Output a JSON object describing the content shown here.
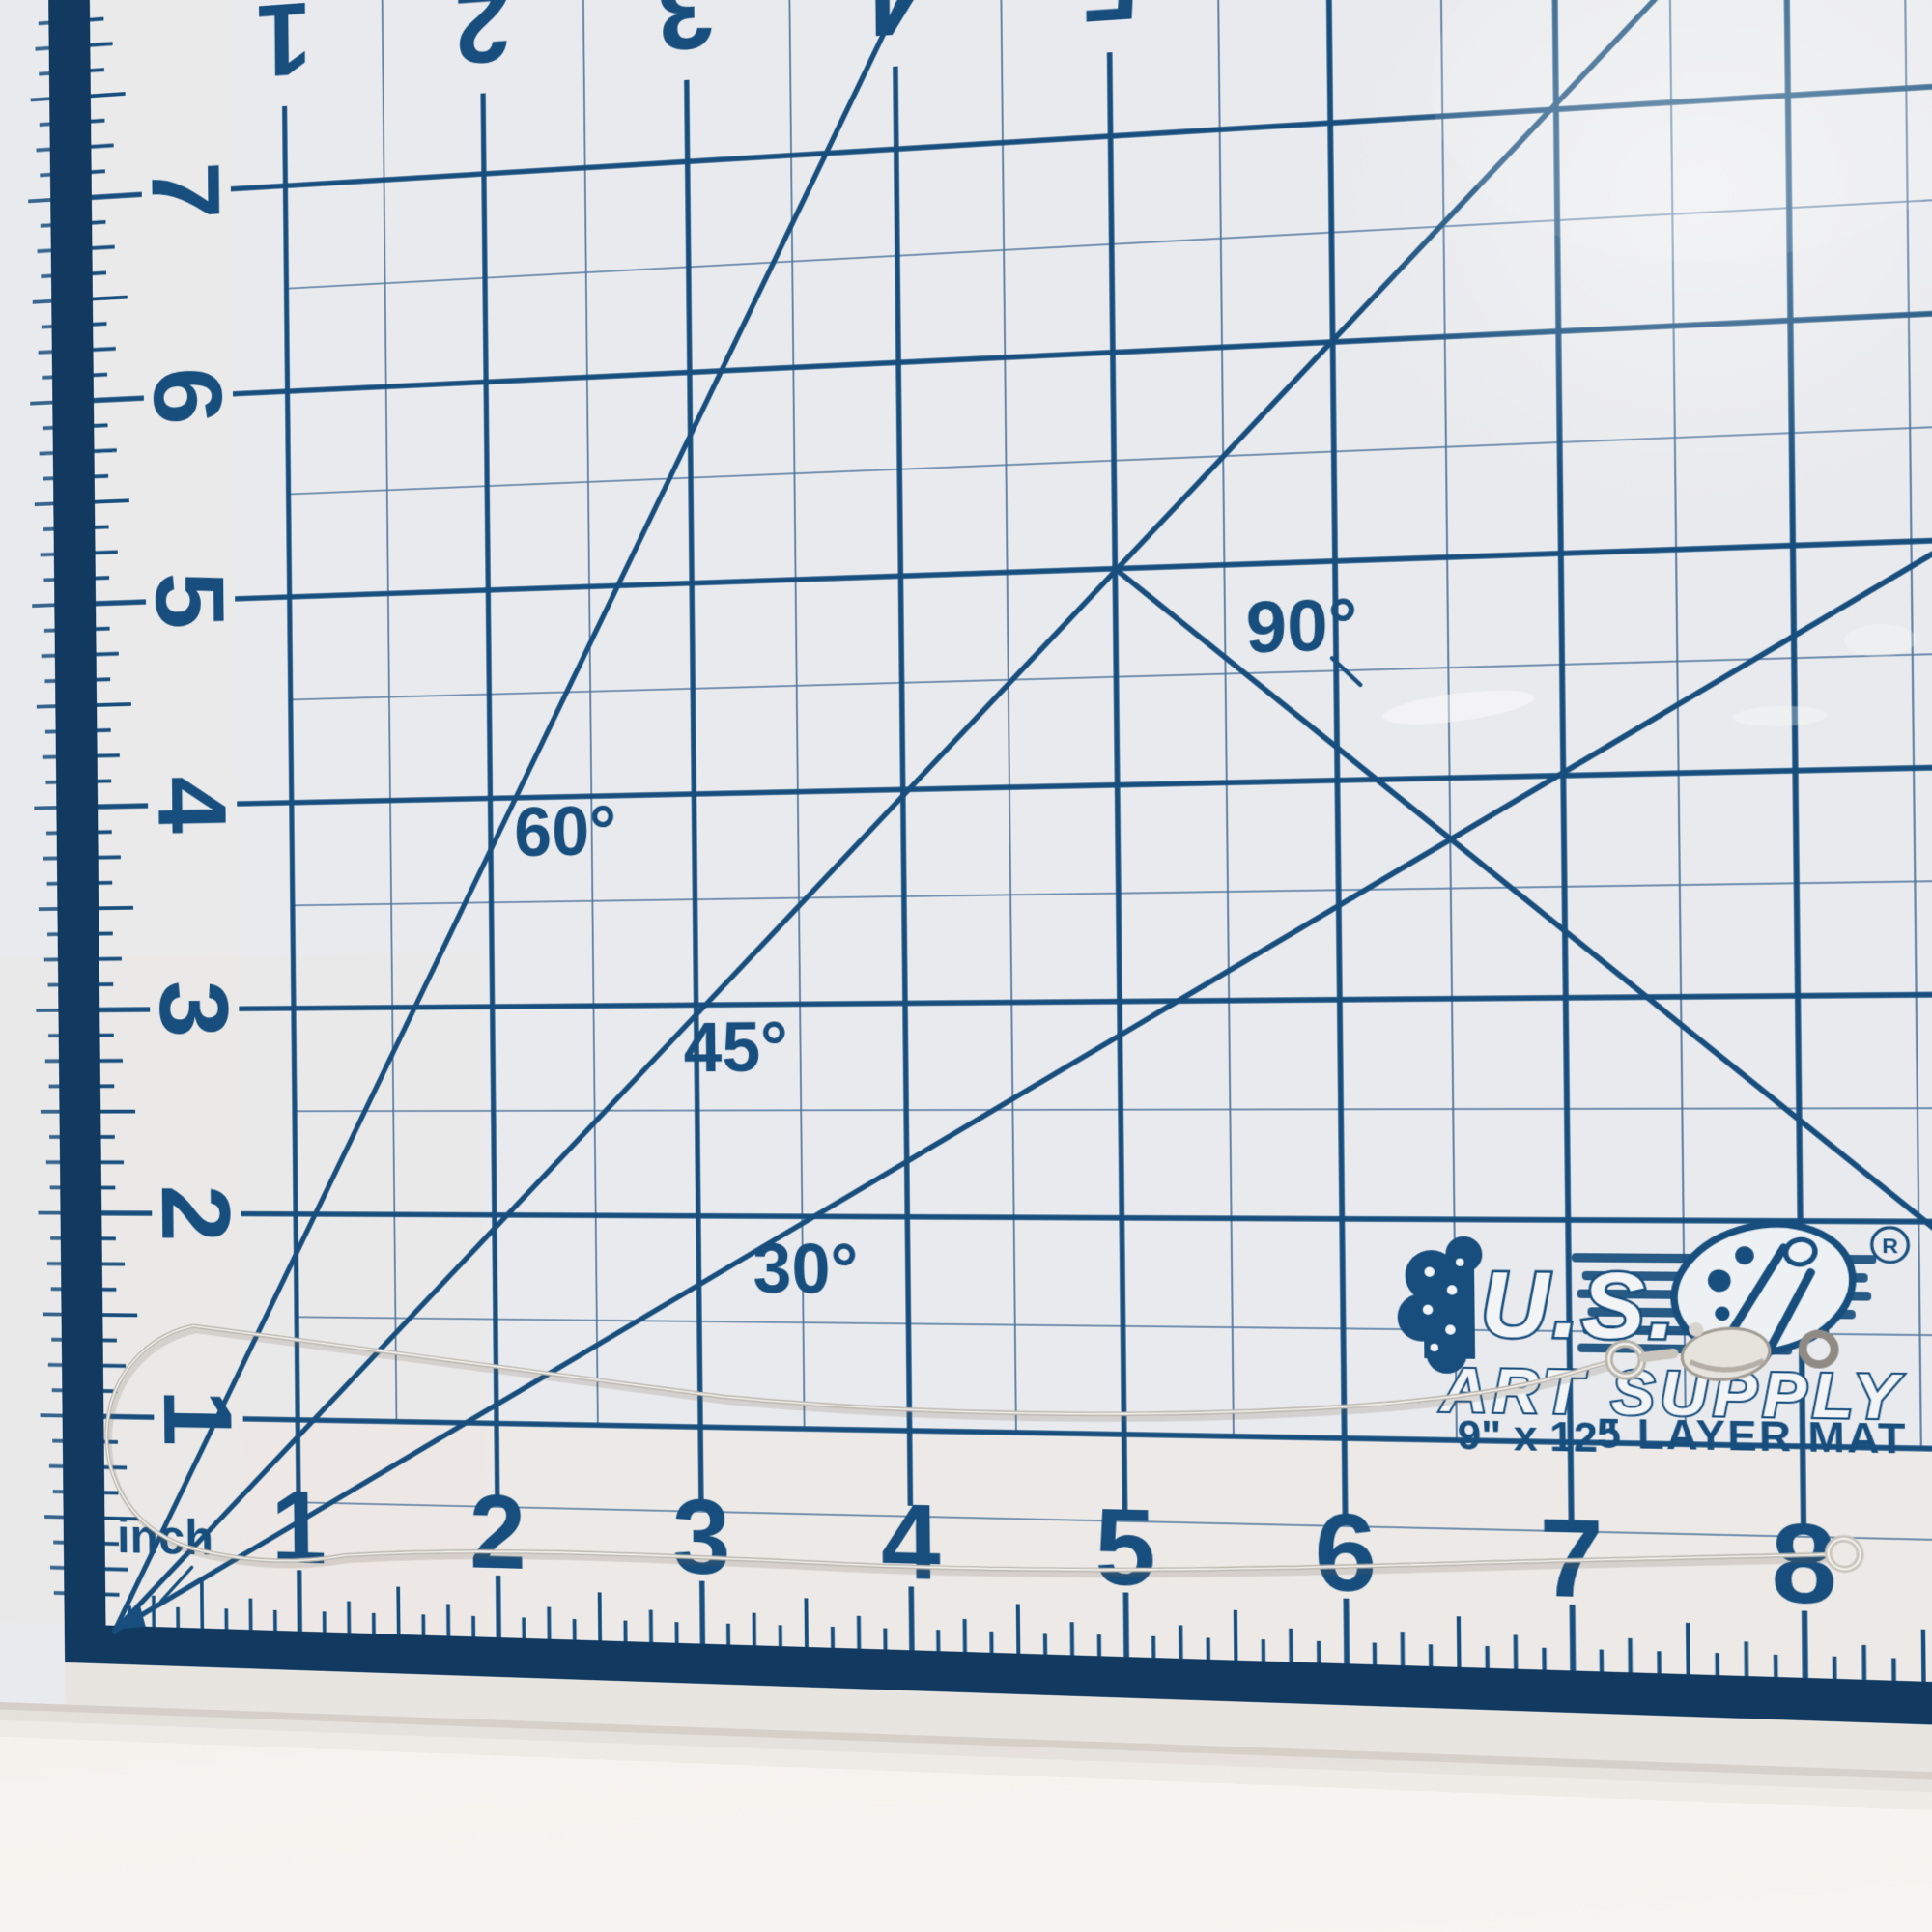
{
  "photo": {
    "subject": "silver necklace chain laid open on a cutting mat",
    "objects": [
      "cutting mat",
      "snake chain necklace",
      "lobster clasp",
      "jump ring"
    ]
  },
  "mat": {
    "unit_label": "inch",
    "angle_labels": [
      "30°",
      "45°",
      "60°",
      "90°"
    ],
    "top_ruler_numbers": [
      "1",
      "2",
      "3",
      "4",
      "5"
    ],
    "left_ruler_numbers": [
      "7",
      "6",
      "5",
      "4",
      "3",
      "2",
      "1"
    ],
    "bottom_ruler_numbers": [
      "1",
      "2",
      "3",
      "4",
      "5",
      "6",
      "7",
      "8"
    ],
    "logo": {
      "brand_line1": "U.S.",
      "brand_line2": "ART SUPPLY",
      "registered_mark": "®",
      "registered_letter": "R",
      "size_text": "9\" x 12\"",
      "layer_text": "5 LAYER MAT"
    },
    "colors": {
      "print_navy": "#174e7d",
      "thin_line": "#4f749c",
      "edge_band": "#123a61",
      "mat_surface": "#e9eaed",
      "warm_tint": "#efe8df",
      "table": "#f1eeea",
      "chain_silver": "#b9b4ac",
      "chain_highlight": "#f6f5f2",
      "clasp_silver": "#e6e3dd"
    }
  }
}
